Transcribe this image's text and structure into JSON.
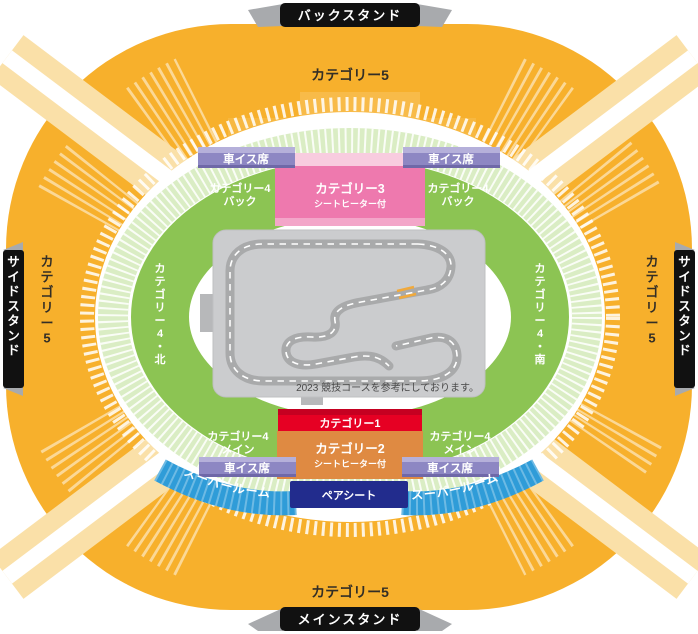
{
  "banners": {
    "top": "バックスタンド",
    "bottom": "メインスタンド",
    "left": "サイドスタンド",
    "right": "サイドスタンド"
  },
  "category5": {
    "top": "カテゴリー5",
    "bottom": "カテゴリー5",
    "left": "カテゴリー5",
    "right": "カテゴリー5"
  },
  "category4": {
    "back_line1": "カテゴリー4",
    "back_line2": "バック",
    "main_line1": "カテゴリー4",
    "main_line2": "メイン",
    "north": "カテゴリー4・北",
    "south": "カテゴリー4・南"
  },
  "category3": {
    "name": "カテゴリー3",
    "sub": "シートヒーター付"
  },
  "category2": {
    "name": "カテゴリー2",
    "sub": "シートヒーター付"
  },
  "category1": {
    "name": "カテゴリー1"
  },
  "wheelchair": {
    "label": "車イス席"
  },
  "super_room": {
    "label_left": "スーパールーム",
    "label_right": "スーパールーム"
  },
  "pair_seat": {
    "label": "ペアシート"
  },
  "track": {
    "note": "2023 競技コースを参考にしております。"
  },
  "colors": {
    "stand": "#F7B02C",
    "stand_bevel": "#FAE0A8",
    "cat4_green": "#8CC453",
    "cat4_fringe": "#DAEDC4",
    "cat3_pink": "#EE79AE",
    "cat3_pink_light": "#F8CCDF",
    "cat3_pink_mid": "#F3A6C9",
    "cat1_red": "#E60023",
    "cat1_red_dark": "#C50021",
    "cat2_orange": "#DF8A42",
    "wheelchair_purple": "#8D87C3",
    "wheelchair_purple_light": "#B5B0DA",
    "super_room_blue": "#2F9CD8",
    "pair_seat_navy": "#222C8D",
    "track_bg": "#CBCCCE",
    "road": "#A9AAAB",
    "banner_black": "#111111",
    "start_line_orange": "#F0A93C"
  }
}
